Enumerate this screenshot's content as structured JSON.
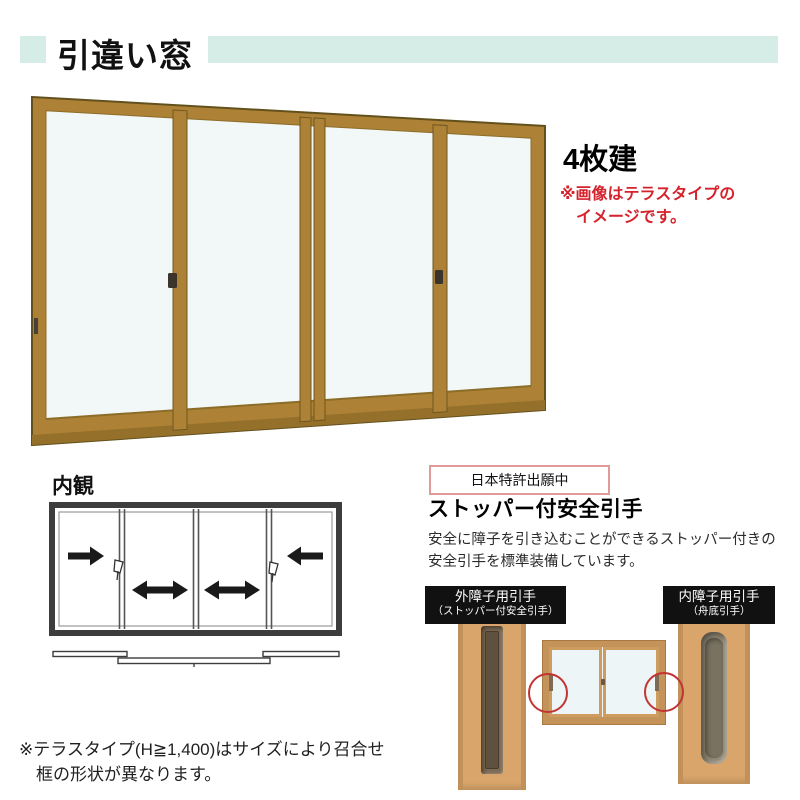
{
  "colors": {
    "accent_teal": "#d5ece7",
    "accent_red": "#d5232d",
    "frame_gold": "#ad8136",
    "diagram_line": "#3d3d3d",
    "circle_red": "#c23434",
    "label_bg": "#111111"
  },
  "header": {
    "title": "引違い窓"
  },
  "product": {
    "type_label": "4枚建",
    "image_note_line1": "※画像はテラスタイプの",
    "image_note_line2": "イメージです。"
  },
  "interior": {
    "label": "内観"
  },
  "feature": {
    "patent_badge": "日本特許出願中",
    "heading": "ストッパー付安全引手",
    "desc_line1": "安全に障子を引き込むことができるストッパー付きの",
    "desc_line2": "安全引手を標準装備しています。",
    "outer_handle_label_line1": "外障子用引手",
    "outer_handle_label_line2": "（ストッパー付安全引手）",
    "inner_handle_label_line1": "内障子用引手",
    "inner_handle_label_line2": "（舟底引手）"
  },
  "footer": {
    "note_line1": "※テラスタイプ(H≧1,400)はサイズにより召合せ",
    "note_line2": "框の形状が異なります。"
  }
}
